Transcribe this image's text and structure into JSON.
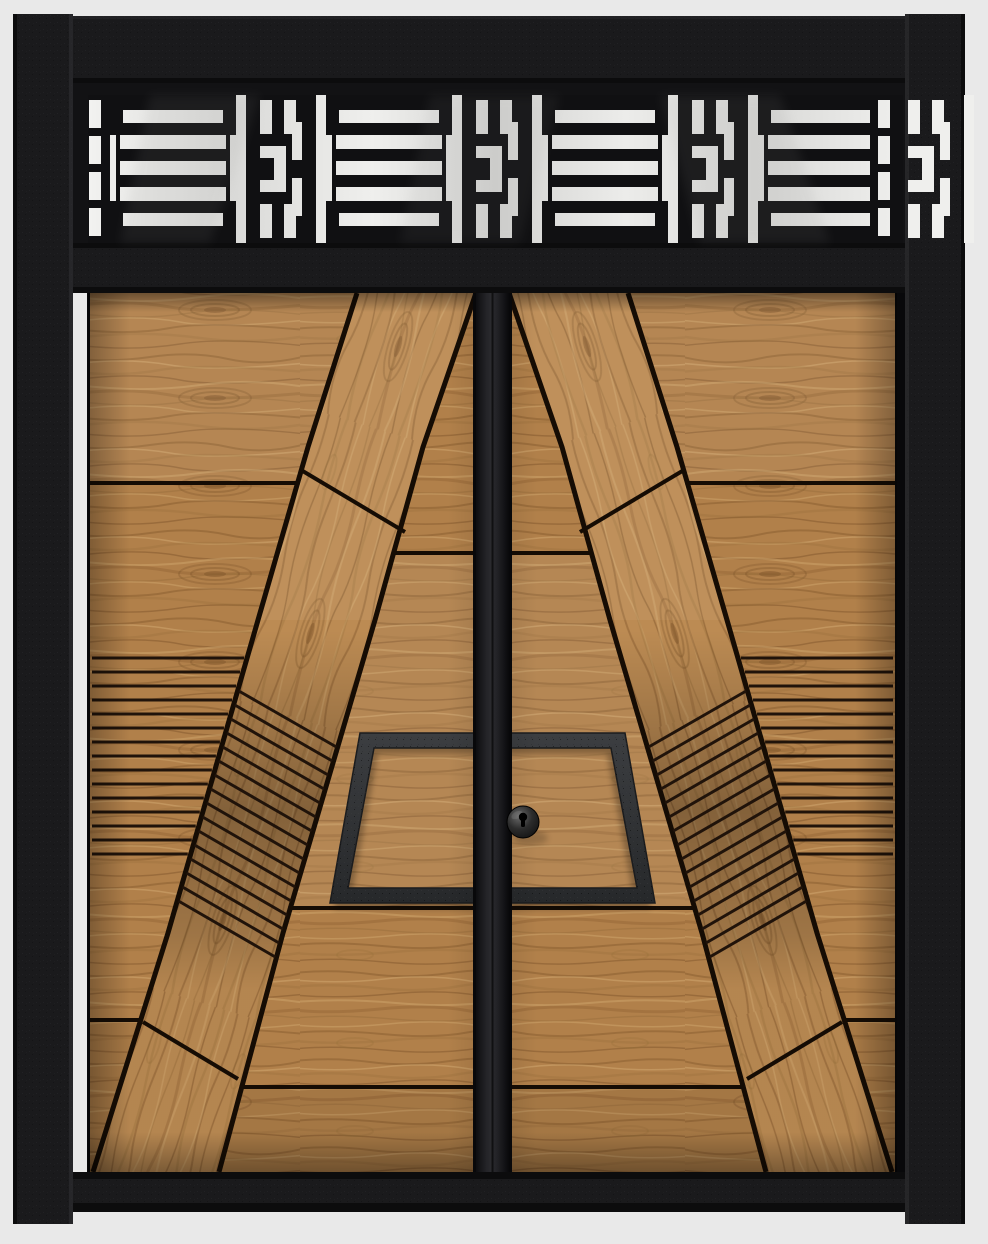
{
  "scene": {
    "width": 988,
    "height": 1244,
    "background": "#e9e9e9",
    "subject": "modern wooden double entry door with fretwork transom"
  },
  "palette": {
    "background": "#e9e9e9",
    "frame_base": "#1a1a1c",
    "frame_dark": "#0c0c0d",
    "frame_edge_light": "#313134",
    "frame_panel": "#121214",
    "fret_black": "#101012",
    "glass_a": "#f1f1ef",
    "glass_b": "#d5d5d3",
    "wood_base": "#b1804a",
    "wood_band": "#bc8b53",
    "grain_dark": "#7c5228",
    "grain_mid": "#966d3a",
    "grain_light": "#d8af76",
    "seam": "#150c04",
    "groove": "#20130a",
    "plate_light": "#3c3e41",
    "plate_dark": "#26282a",
    "plate_edge": "#1b1c1e",
    "knob_hi": "#6a6a6a",
    "knob_mid": "#2c2c2c",
    "knob_dark": "#0a0a0a",
    "stile_mid": "#232327",
    "stile_dark": "#09090b",
    "gap_dark": "#08080a"
  },
  "frame": {
    "left_jamb": {
      "x": 13,
      "y": 14,
      "w": 60,
      "h": 1210
    },
    "right_jamb": {
      "x": 905,
      "y": 14,
      "w": 60,
      "h": 1210
    },
    "top_rail": {
      "x": 73,
      "y": 16,
      "w": 832,
      "h": 67
    },
    "transom_base": {
      "x": 73,
      "y": 83,
      "w": 832,
      "h": 160
    },
    "mid_rail": {
      "x": 73,
      "y": 243,
      "w": 832,
      "h": 50
    },
    "door_opening": {
      "x": 87,
      "y": 293,
      "w": 818,
      "h": 879
    },
    "sill": {
      "x": 73,
      "y": 1172,
      "w": 832,
      "h": 40
    }
  },
  "transom": {
    "glass": {
      "x": 88,
      "y": 95,
      "w": 814,
      "h": 148
    },
    "cell_starts": [
      110,
      326,
      542,
      758
    ],
    "module_stripes_w": 126,
    "slot_offsets": [
      126,
      206
    ],
    "slot_w": 10,
    "h_module_offset": 148,
    "h_module_w": 46,
    "stripes_whites": [
      [
        13,
        15,
        100,
        13
      ],
      [
        10,
        40,
        106,
        14
      ],
      [
        10,
        66,
        106,
        14
      ],
      [
        10,
        92,
        106,
        14
      ],
      [
        13,
        118,
        100,
        13
      ],
      [
        0,
        40,
        6,
        66
      ],
      [
        120,
        40,
        6,
        66
      ]
    ],
    "h_whites": [
      [
        2,
        5,
        12,
        34
      ],
      [
        26,
        5,
        12,
        22
      ],
      [
        26,
        27,
        18,
        12
      ],
      [
        34,
        39,
        10,
        26
      ],
      [
        2,
        51,
        26,
        12
      ],
      [
        16,
        63,
        12,
        28
      ],
      [
        2,
        109,
        12,
        34
      ],
      [
        26,
        121,
        12,
        22
      ],
      [
        26,
        109,
        18,
        12
      ],
      [
        34,
        83,
        10,
        26
      ],
      [
        2,
        85,
        26,
        12
      ],
      [
        16,
        57,
        12,
        28
      ]
    ],
    "right_mask": {
      "x": 870,
      "y": 95,
      "w": 33,
      "h": 148
    },
    "dash_columns": [
      {
        "x": 89,
        "w": 12
      },
      {
        "x": 878,
        "w": 12
      }
    ],
    "dash_ys": [
      [
        100,
        28
      ],
      [
        136,
        28
      ],
      [
        172,
        28
      ],
      [
        208,
        28
      ]
    ],
    "reflections": [
      {
        "points": "150,95 260,95 210,243 120,243",
        "opacity": 0.1
      },
      {
        "points": "430,95 560,95 520,243 400,243",
        "opacity": 0.08
      },
      {
        "points": "660,95 780,95 830,243 700,243",
        "opacity": 0.1
      }
    ]
  },
  "door": {
    "top": 293,
    "bottom": 1172,
    "left_x": 90,
    "inner_x": 509,
    "mirror_sum": 985,
    "band_left": [
      [
        357,
        293
      ],
      [
        308,
        447
      ],
      [
        258,
        620
      ],
      [
        168,
        933
      ],
      [
        93,
        1172
      ]
    ],
    "band_right": [
      [
        476,
        293
      ],
      [
        423,
        447
      ],
      [
        375,
        620
      ],
      [
        283,
        933
      ],
      [
        219,
        1172
      ]
    ],
    "outer_seams": [
      483,
      1020
    ],
    "inner_seams": [
      553,
      908,
      1087
    ],
    "cross_seams": [
      [
        301,
        470,
        405,
        532
      ],
      [
        143,
        1022,
        238,
        1079
      ]
    ],
    "grooves_outer": {
      "y_start": 658,
      "y_end": 854,
      "count": 15
    },
    "grooves_band": {
      "y_start": 690,
      "y_end": 900,
      "count": 16,
      "drop": 58
    },
    "plate_path": "M474,733 L360,733 L330,903 L474,903 L474,888 L348,888 L374,748 L474,748 Z",
    "stile": {
      "x": 476,
      "w": 33
    },
    "knob": {
      "cx": 523,
      "cy": 822,
      "r": 16,
      "keyhole_r": 4.2
    }
  }
}
